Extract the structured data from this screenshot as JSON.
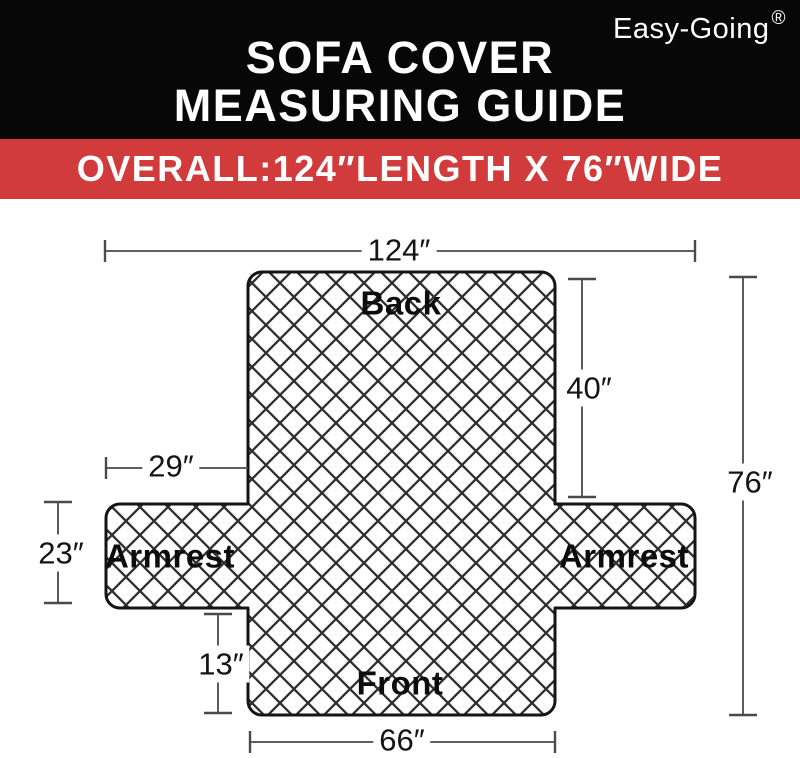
{
  "brand": {
    "name": "Easy-Going",
    "registered_mark": "®"
  },
  "header": {
    "title_line1": "SOFA COVER",
    "title_line2": "MEASURING GUIDE"
  },
  "banner": {
    "text": "OVERALL:124″LENGTH X 76″WIDE"
  },
  "diagram": {
    "section_labels": {
      "back": "Back",
      "armrest_left": "Armrest",
      "armrest_right": "Armrest",
      "front": "Front"
    },
    "measurements": {
      "overall_length": "124″",
      "back_height": "40″",
      "overall_width": "76″",
      "armrest_length": "29″",
      "armrest_height": "23″",
      "front_height": "13″",
      "front_width": "66″"
    },
    "colors": {
      "header_black": "#070707",
      "banner_red": "#d23b3b",
      "quilt_line": "#2f2f2f",
      "outline": "#141414",
      "dimension_line": "#4a4a4a"
    }
  }
}
